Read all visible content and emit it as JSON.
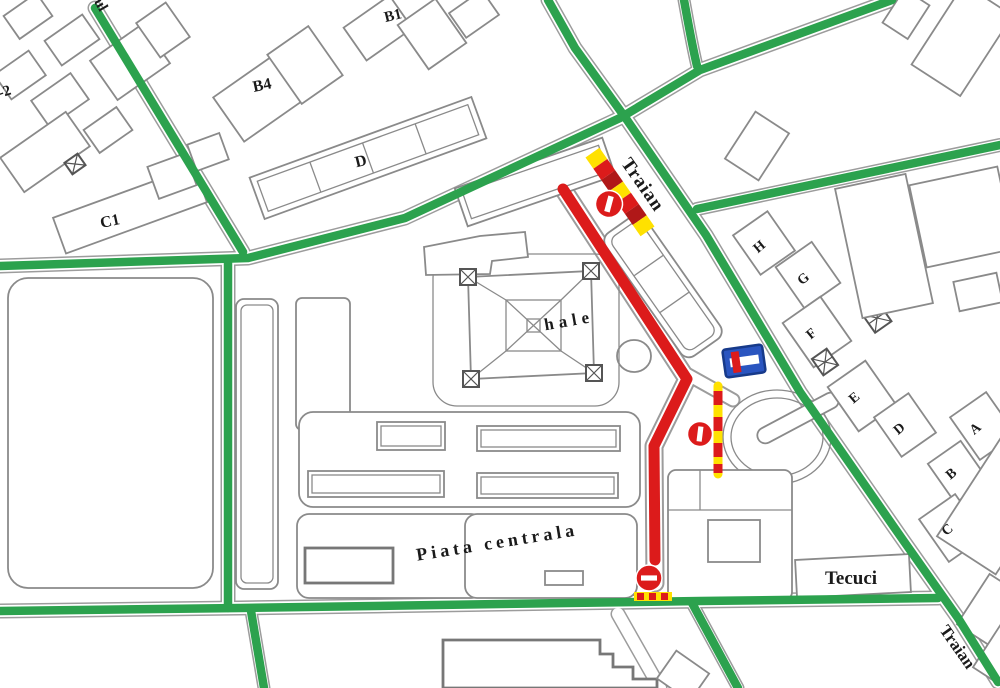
{
  "map_title": "Schematic street map of the Piata centrala / hale market area with closed road route marked in red",
  "labels": {
    "streets": {
      "traian_top": "Traian",
      "traian_bottom": "Traian",
      "tecuci": "Tecuci",
      "partial_top": "ul"
    },
    "areas": {
      "hale": "hale",
      "piata_centrala": "Piata centrala"
    },
    "buildings": {
      "b1": "B1",
      "b4": "B4",
      "d_left": "D",
      "c1": "C1",
      "edge_left": "-2",
      "h": "H",
      "g": "G",
      "f": "F",
      "e": "E",
      "d_right": "D",
      "a": "A",
      "b": "B",
      "c": "C"
    }
  },
  "signs": {
    "no_entry_signs": 3,
    "dead_end_sign": 1,
    "striped_barriers": 3
  },
  "colors": {
    "street_green": "#2ca24e",
    "route_red": "#dc1b1b",
    "barrier_yellow": "#ffe100",
    "sign_blue": "#2a55c0",
    "sign_blue_border": "#173a8a",
    "building_outline": "#8a8a8a",
    "text": "#1a1a1a"
  }
}
